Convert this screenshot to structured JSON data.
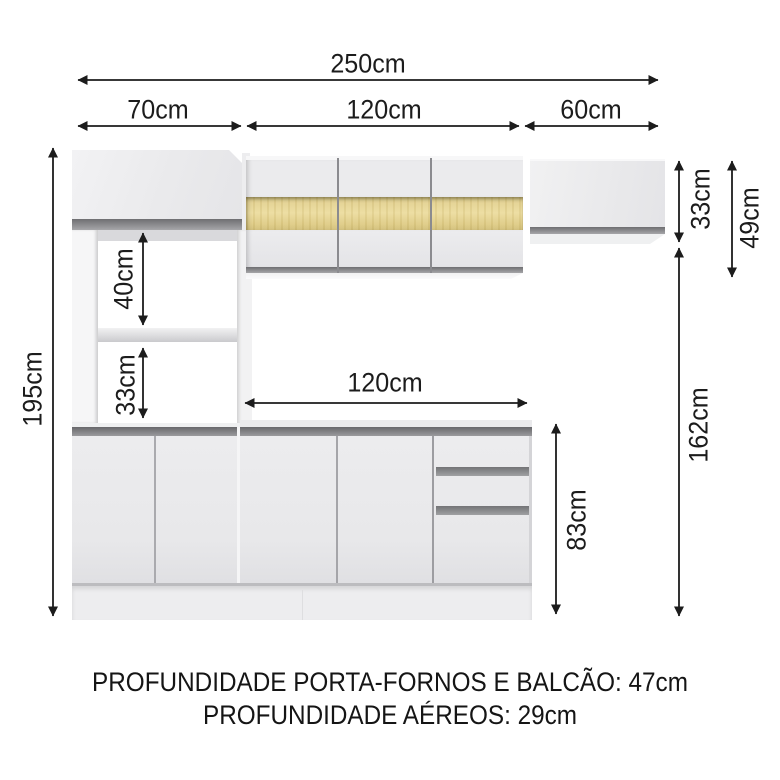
{
  "diagram": {
    "subject": "kitchen-cabinet-set-dimension-diagram"
  },
  "labels": {
    "total_width": "250cm",
    "section_left": "70cm",
    "section_middle": "120cm",
    "section_right": "60cm",
    "height_total": "195cm",
    "niche_upper": "40cm",
    "niche_lower": "33cm",
    "aerial_small_height": "33cm",
    "aerial_main_height": "49cm",
    "tower_lower_span": "162cm",
    "counter_width": "120cm",
    "counter_height": "83cm"
  },
  "footer": {
    "line1": "PROFUNDIDADE PORTA-FORNOS E BALCÃO: 47cm",
    "line2": "PROFUNDIDADE AÉREOS: 29cm"
  },
  "colors": {
    "background": "#ffffff",
    "dimension_line": "#1c1c1c",
    "cabinet_face": "#eaeaec",
    "trim_gray": "#88888b",
    "wood_band": "#e2d08e"
  }
}
